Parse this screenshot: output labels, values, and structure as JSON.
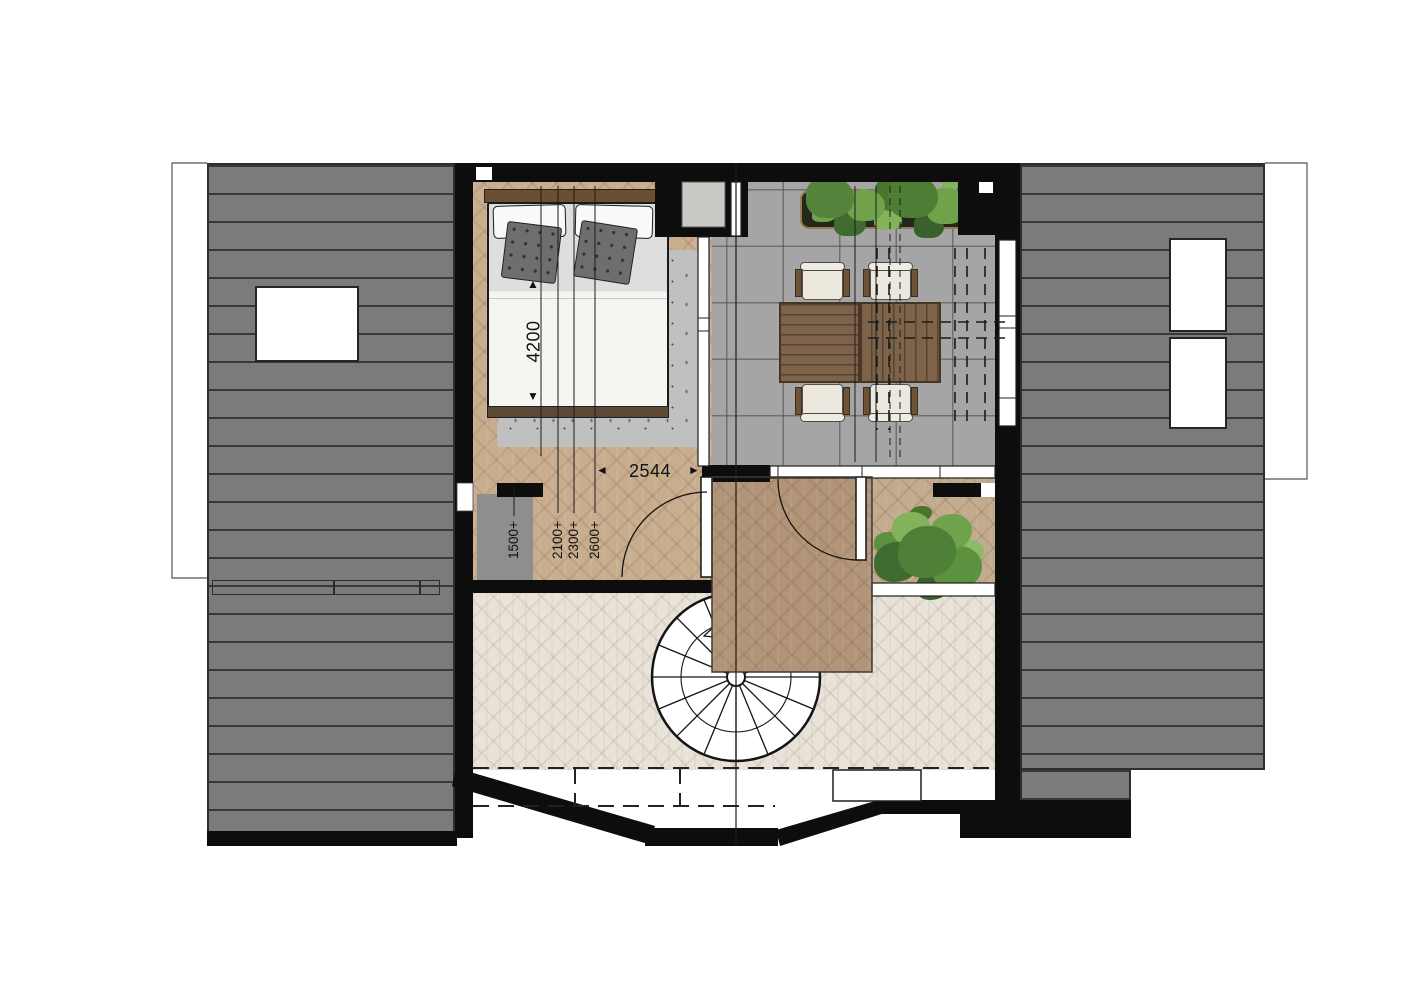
{
  "plan": {
    "type": "floor-plan",
    "dimensions": {
      "bed_length": "4200",
      "opening_width": "2544",
      "headroom_contours": [
        "1500+",
        "2100+",
        "2300+",
        "2600+"
      ]
    },
    "icons": {
      "arrow_up": "▲",
      "arrow_down": "▼",
      "arrow_left": "◄",
      "arrow_right": "►"
    },
    "colors": {
      "roof": "#7b7b7b",
      "roof_line": "#383838",
      "wall": "#0d0d0d",
      "terrace_tile": "#a5a5a5",
      "wood_bedroom_hall": "#c8ae8f",
      "wood_landing": "#b29578",
      "wood_walkway": "#c2ab8e",
      "wood_pale": "#e8e2d9",
      "rug": "#c0c0c0",
      "low_headroom_zone": "#8e8e8e",
      "table_wood": "#7d6349",
      "chair_seat": "#ece8dd",
      "chair_frame": "#6f5336",
      "foliage_dark": "#3f6b2e",
      "foliage_mid": "#5c9140",
      "foliage_light": "#8dba66",
      "planter_rim": "#9b7b4e"
    }
  }
}
